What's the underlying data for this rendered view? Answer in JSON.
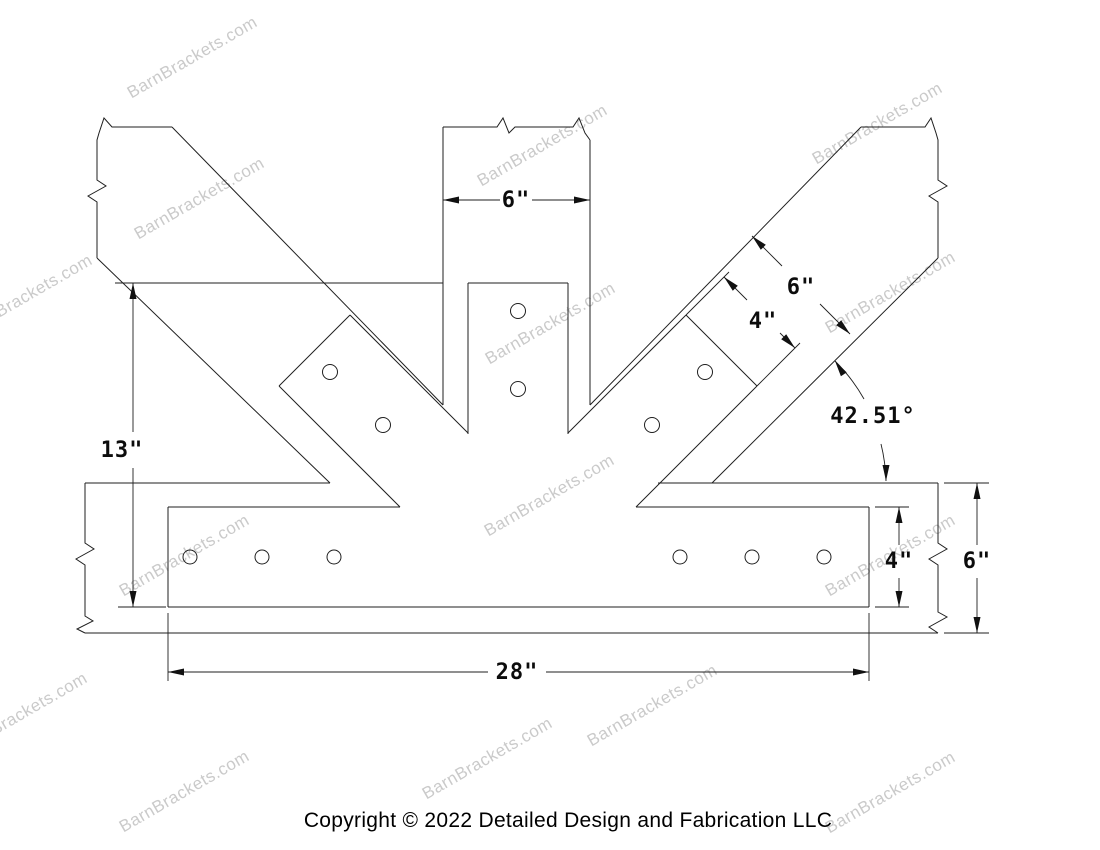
{
  "watermark": {
    "text": "BarnBrackets.com",
    "color": "#c5c5c5"
  },
  "dimensions": {
    "post_width": "6\"",
    "brace_width": "6\"",
    "brace_plate_width": "4\"",
    "brace_angle": "42.51°",
    "overall_height": "13\"",
    "plate_height": "4\"",
    "beam_height": "6\"",
    "plate_length": "28\""
  },
  "footer": {
    "copyright": "Copyright © 2022 Detailed Design and Fabrication LLC"
  }
}
